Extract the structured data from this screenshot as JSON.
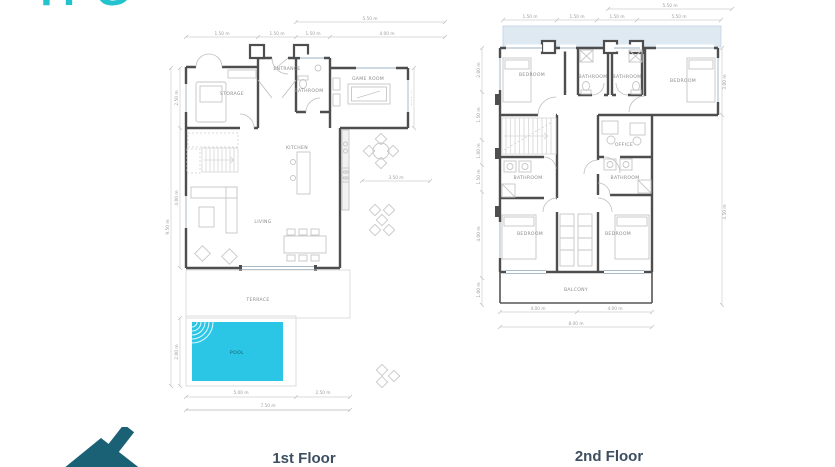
{
  "brand": {
    "logo_text": "TPG"
  },
  "captions": {
    "floor1": "1st Floor",
    "floor2": "2nd Floor"
  },
  "colors": {
    "pool": "#2bc6e6",
    "roof_band": "#dfe9f2",
    "brand": "#22c3ce",
    "house_logo": "#1b6176",
    "wall": "#4e4e4e",
    "caption": "#3d4e61"
  },
  "floor1": {
    "rooms": {
      "storage": "STORAGE",
      "entrance": "ENTRANCE",
      "bathroom": "BATHROOM",
      "game_room": "GAME ROOM",
      "kitchen": "KITCHEN",
      "living": "LIVING",
      "terrace": "TERRACE",
      "pool": "POOL"
    },
    "dims": {
      "top": [
        "1.50 m",
        "1.50 m",
        "1.50 m",
        "4.00 m"
      ],
      "top_overall": "5.50 m",
      "right_v": "3.50 m",
      "right_h": "3.50 m",
      "left": [
        "2.50 m",
        "4.00 m",
        "9.50 m",
        "2.00 m"
      ],
      "bottom": [
        "5.00 m",
        "2.50 m"
      ],
      "bottom_overall": "7.50 m"
    }
  },
  "floor2": {
    "rooms": {
      "bedroom_tl": "BEDROOM",
      "bathroom_a": "BATHROOM",
      "bathroom_b": "BATHROOM",
      "bedroom_tr": "BEDROOM",
      "office": "OFFICE",
      "bathroom_c": "BATHROOM",
      "bathroom_d": "BATHROOM",
      "bedroom_bl": "BEDROOM",
      "bedroom_br": "BEDROOM",
      "balcony": "BALCONY"
    },
    "dims": {
      "top": [
        "1.50 m",
        "1.50 m",
        "1.50 m",
        "5.50 m"
      ],
      "top_overall": "5.50 m",
      "right": [
        "3.00 m",
        "4.50 m"
      ],
      "left": [
        "2.00 m",
        "1.50 m",
        "1.00 m",
        "1.50 m",
        "4.00 m",
        "1.00 m"
      ],
      "bottom": [
        "4.00 m",
        "4.00 m"
      ],
      "bottom_overall": "8.00 m"
    }
  }
}
